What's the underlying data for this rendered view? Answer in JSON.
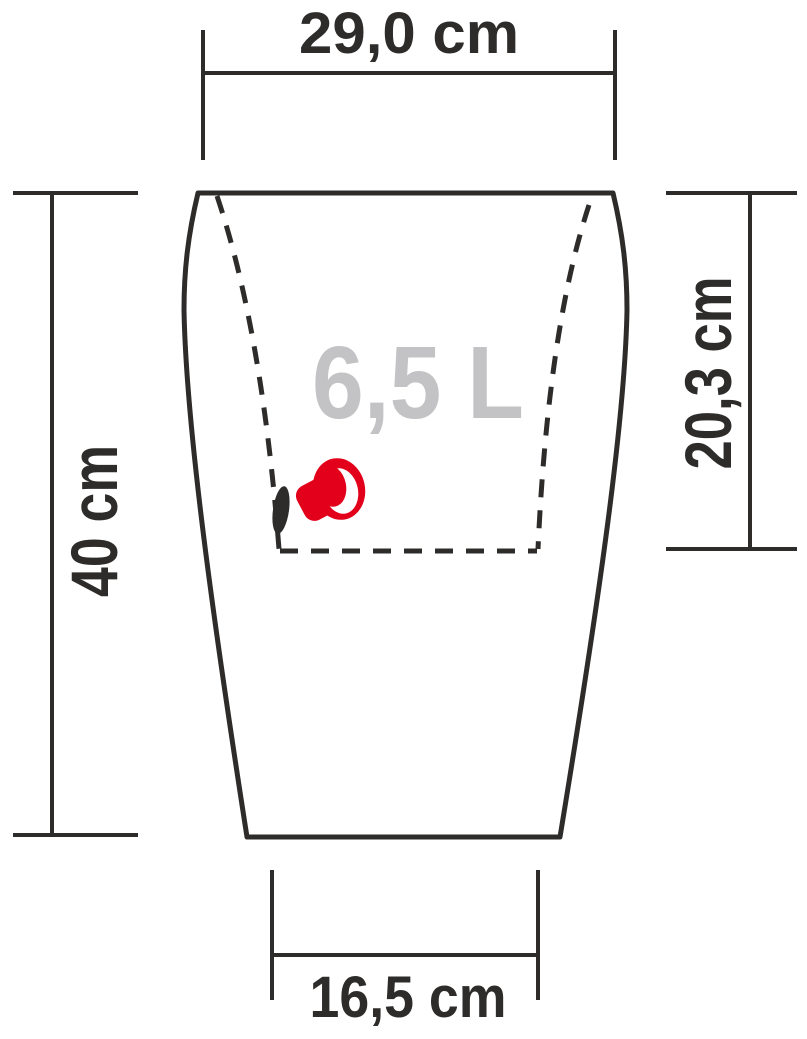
{
  "figure": {
    "volume": {
      "label": "6,5 L"
    },
    "dimensions": {
      "top_width": "29,0 cm",
      "height": "40 cm",
      "planting_depth": "20,3 cm",
      "base_width": "16,5 cm"
    },
    "colors": {
      "line": "#2e2c2b",
      "volume_text": "#c3c3c5",
      "indicator_red": "#e2001a",
      "background": "#ffffff"
    },
    "icons": {
      "water_level_indicator": "red plug knob on liner wall",
      "drain_hole": "black ellipse on dashed liner wall"
    }
  }
}
